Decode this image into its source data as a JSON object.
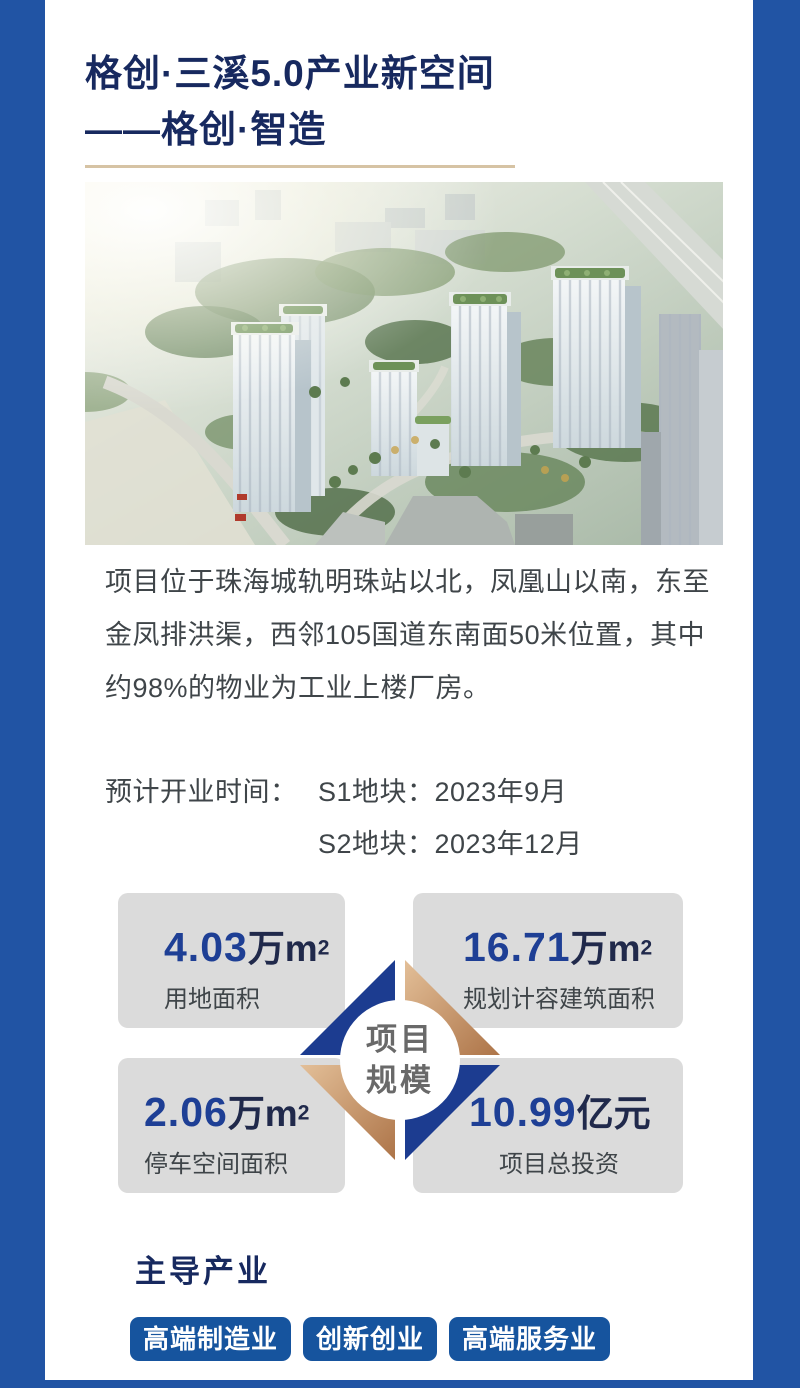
{
  "header": {
    "title_line1": "格创·三溪5.0产业新空间",
    "title_line2": "——格创·智造"
  },
  "location_paragraph": "项目位于珠海城轨明珠站以北，凤凰山以南，东至金凤排洪渠，西邻105国道东南面50米位置，其中约98%的物业为工业上楼厂房。",
  "opening": {
    "label": "预计开业时间：",
    "items": [
      "S1地块：2023年9月",
      "S2地块：2023年12月"
    ]
  },
  "scale_section": {
    "center_line1": "项目",
    "center_line2": "规模",
    "stats": [
      {
        "value": "4.03",
        "unit": "万m",
        "sup": "2",
        "label": "用地面积"
      },
      {
        "value": "16.71",
        "unit": "万m",
        "sup": "2",
        "label": "规划计容建筑面积"
      },
      {
        "value": "2.06",
        "unit": "万m",
        "sup": "2",
        "label": "停车空间面积"
      },
      {
        "value": "10.99",
        "unit": "亿元",
        "sup": "",
        "label": "项目总投资"
      }
    ]
  },
  "industries": {
    "heading": "主导产业",
    "tags": [
      "高端制造业",
      "创新创业",
      "高端服务业"
    ]
  },
  "colors": {
    "c-border": "#2154a4",
    "c-navy-dark": "#17295f",
    "c-num-blue": "#1e3f95",
    "c-unit-navy": "#20294b",
    "c-body": "#3f4549",
    "c-box": "#dbdbdb",
    "c-tan": "#d6c3a4",
    "c-diamond-navy": "#1c3c90",
    "c-tag": "#16549e",
    "c-circle-text": "#696969"
  }
}
